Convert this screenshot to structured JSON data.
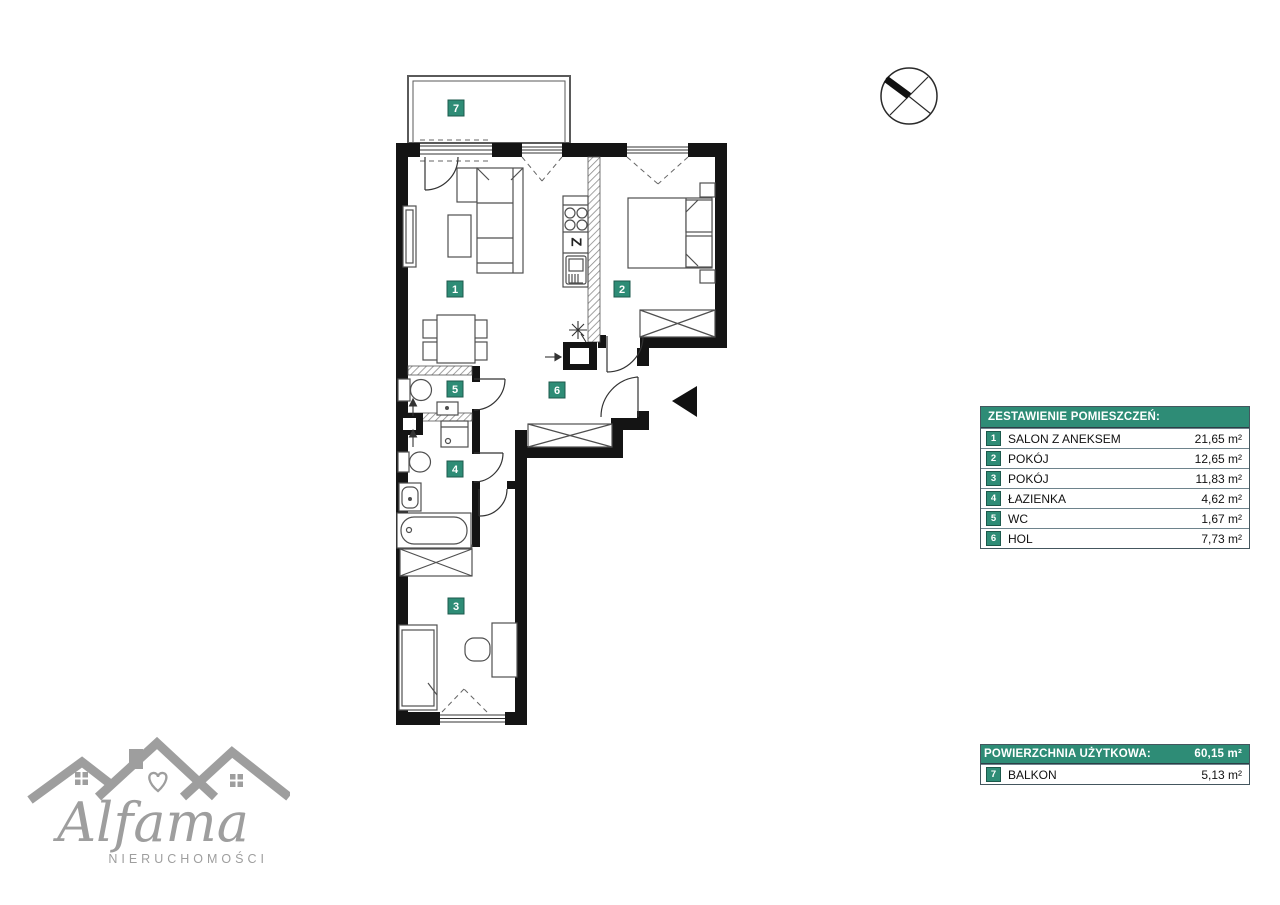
{
  "colors": {
    "accent_teal": "#2E8C76",
    "badge_border": "#1C5A4C",
    "table_border": "#44565E",
    "wall_black": "#141414",
    "furniture_gray": "#4F4F4F",
    "logo_gray": "#9E9E9E"
  },
  "plan": {
    "room_numbers": [
      "1",
      "2",
      "3",
      "4",
      "5",
      "6",
      "7"
    ],
    "sink_label": "Z"
  },
  "legend": {
    "title": "ZESTAWIENIE POMIESZCZEŃ:",
    "rows": [
      {
        "num": "1",
        "name": "SALON Z ANEKSEM",
        "area": "21,65 m²"
      },
      {
        "num": "2",
        "name": "POKÓJ",
        "area": "12,65 m²"
      },
      {
        "num": "3",
        "name": "POKÓJ",
        "area": "11,83 m²"
      },
      {
        "num": "4",
        "name": "ŁAZIENKA",
        "area": "4,62 m²"
      },
      {
        "num": "5",
        "name": "WC",
        "area": "1,67 m²"
      },
      {
        "num": "6",
        "name": "HOL",
        "area": "7,73 m²"
      }
    ]
  },
  "summary": {
    "title": "POWIERZCHNIA UŻYTKOWA:",
    "total": "60,15 m²",
    "rows": [
      {
        "num": "7",
        "name": "BALKON",
        "area": "5,13 m²"
      }
    ]
  },
  "logo": {
    "brand": "Alfama",
    "subtitle": "NIERUCHOMOŚCI"
  }
}
